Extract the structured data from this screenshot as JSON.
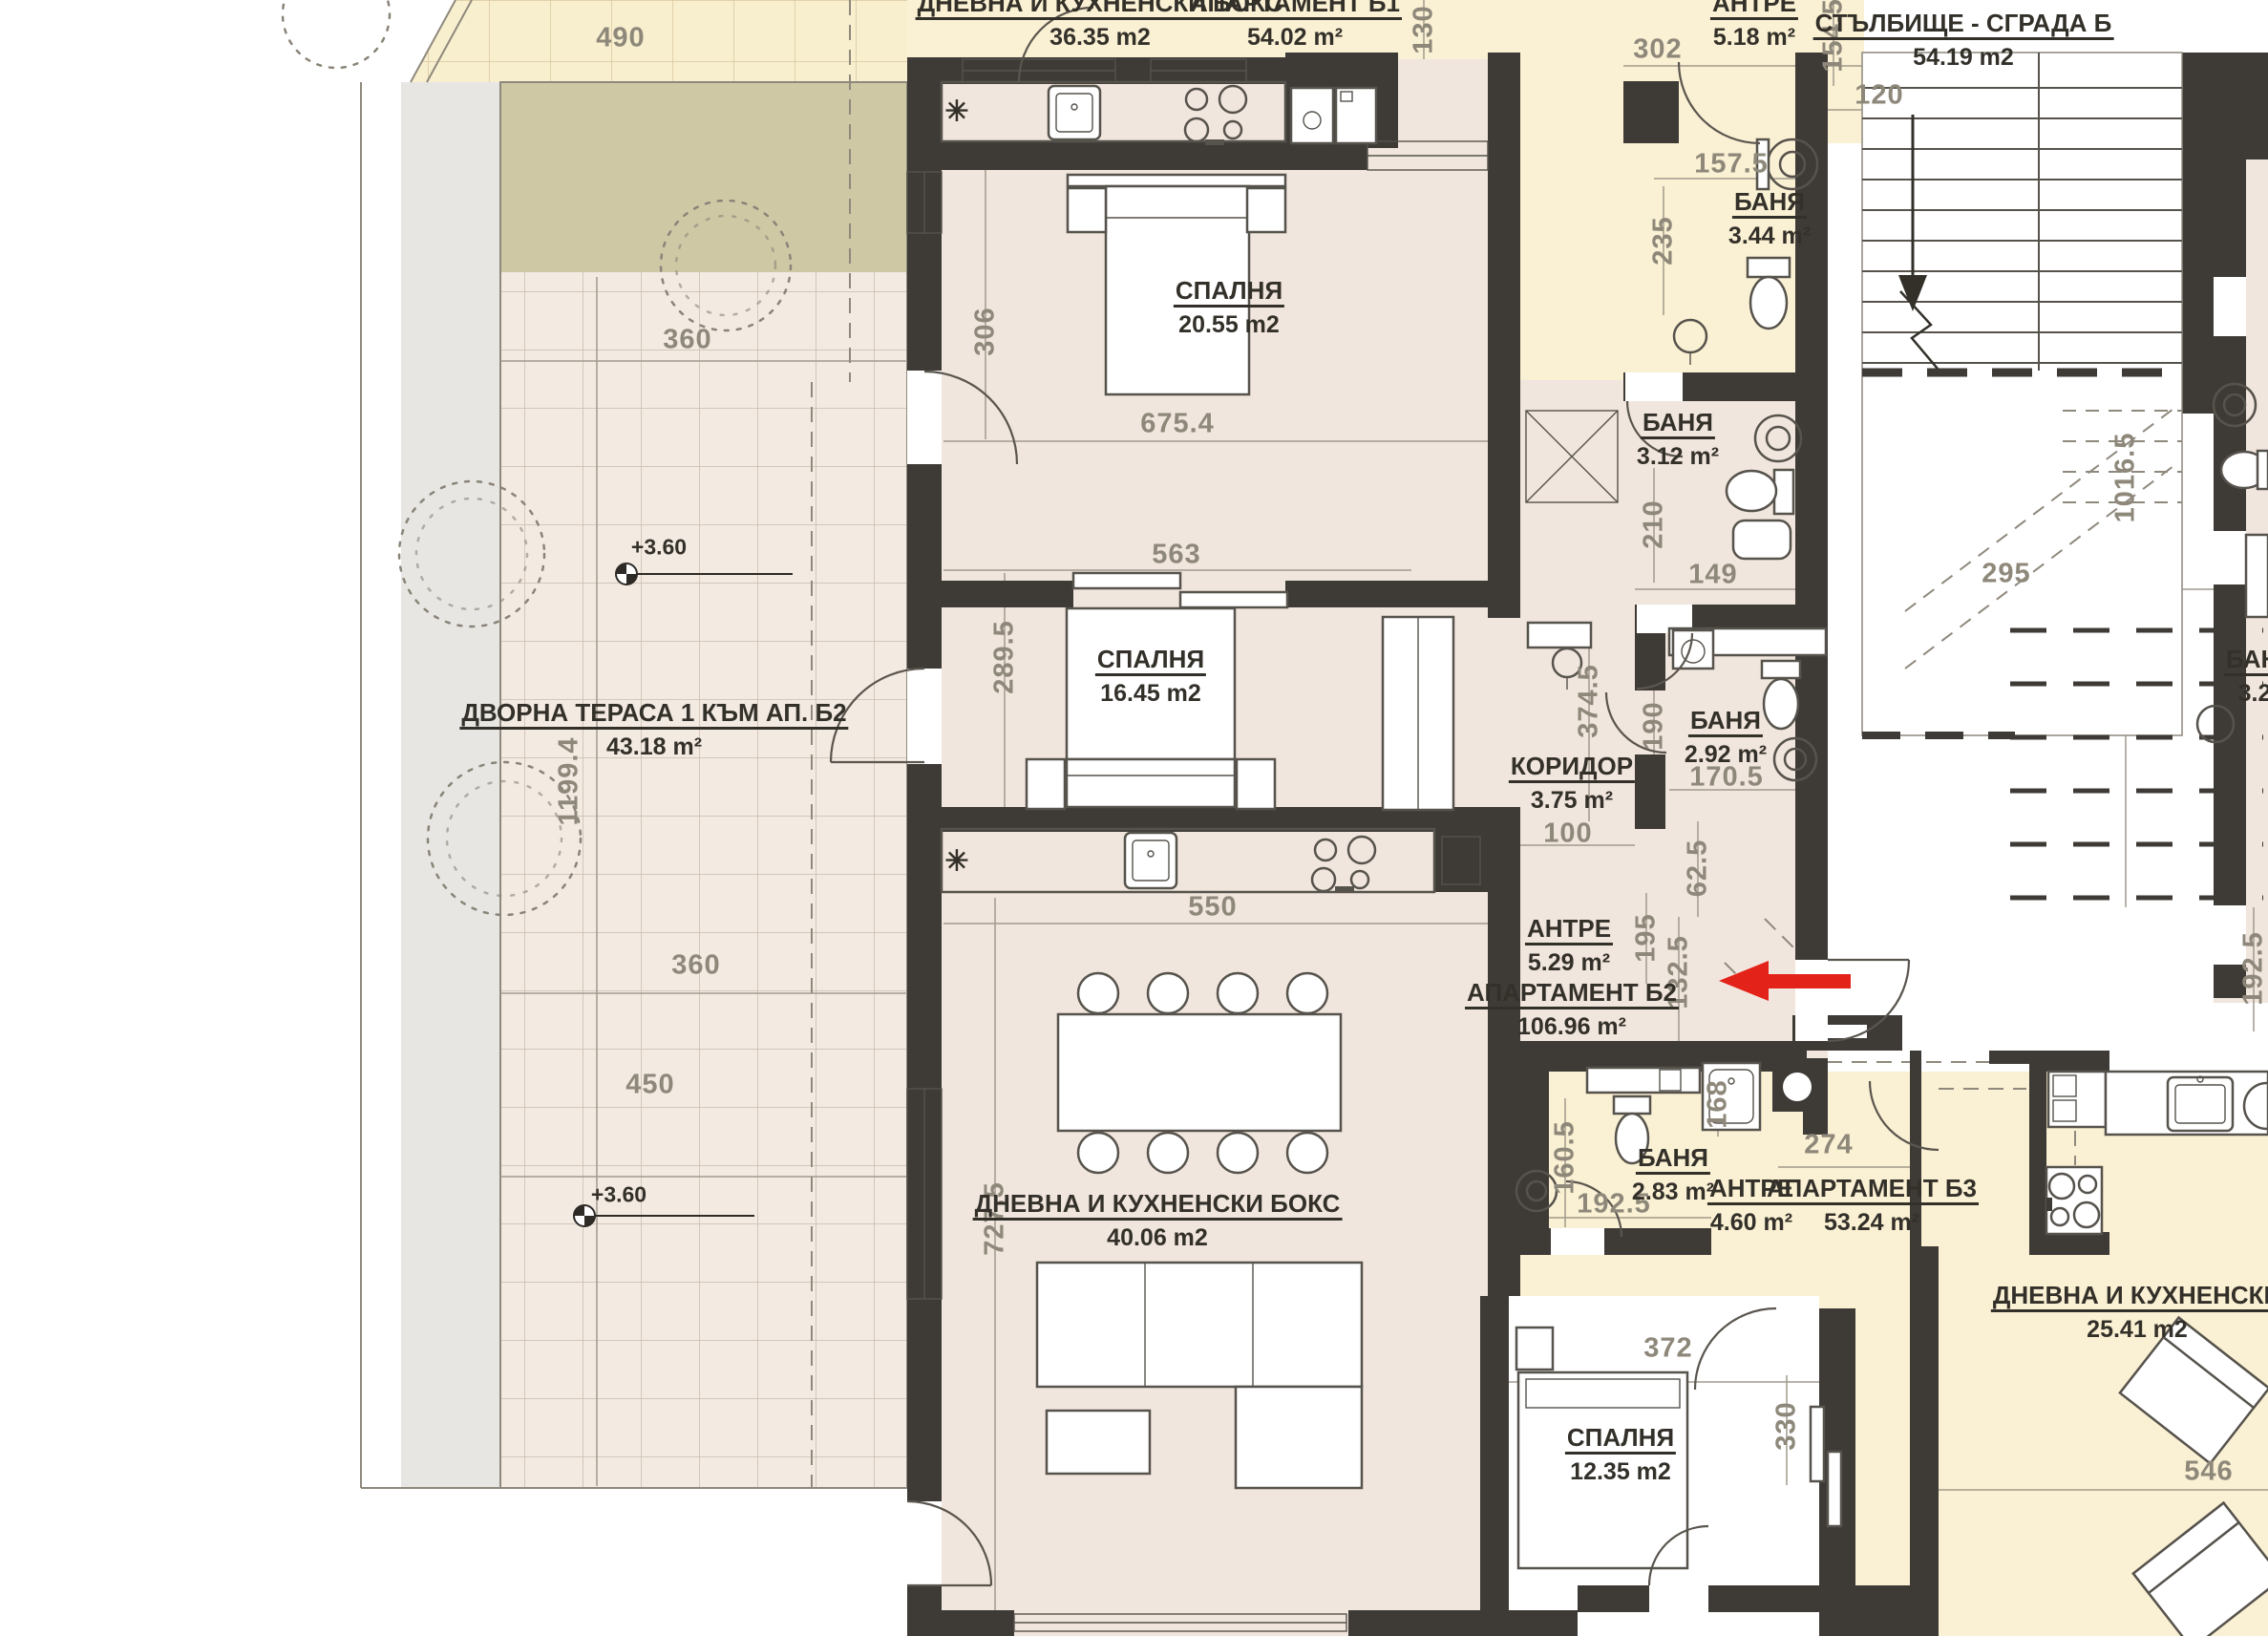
{
  "title": "Floor plan – Building B",
  "colors": {
    "wall": "#3e3a36",
    "room_beige": "#f1e6dd",
    "zone_yellow": "#faf0d3",
    "terrace_tile": "#f3eae2",
    "olive": "#cfc8a5",
    "grey_strip": "#e7e6e3",
    "dim_text": "#8e887a",
    "label_text": "#33302a",
    "arrow_red": "#e32219"
  },
  "labels": {
    "b1_living_name": "ДНЕВНА И КУХНЕНСКИ БОКС",
    "b1_living_area": "36.35 m2",
    "b1_apt_name": "АПАРТАМЕНТ Б1",
    "b1_apt_area": "54.02 m²",
    "b1_antre_name": "АНТРЕ",
    "b1_antre_area": "5.18 m²",
    "b1_bath_name": "БАНЯ",
    "b1_bath_area": "3.44 m²",
    "stairs_name": "СТЪЛБИЩЕ - СГРАДА Б",
    "stairs_area": "54.19 m2",
    "b2_bed1_name": "СПАЛНЯ",
    "b2_bed1_area": "20.55 m2",
    "b2_bath1_name": "БАНЯ",
    "b2_bath1_area": "3.12 m²",
    "b2_bed2_name": "СПАЛНЯ",
    "b2_bed2_area": "16.45 m2",
    "terrace_name": "ДВОРНА ТЕРАСА 1 КЪМ АП. Б2",
    "terrace_area": "43.18 m²",
    "b2_corridor_name": "КОРИДОР",
    "b2_corridor_area": "3.75 m²",
    "b2_bath2_name": "БАНЯ",
    "b2_bath2_area": "2.92 m²",
    "b2_antre_name": "АНТРЕ",
    "b2_antre_area": "5.29 m²",
    "b2_apt_name": "АПАРТАМЕНТ Б2",
    "b2_apt_area": "106.96 m²",
    "b2_living_name": "ДНЕВНА И КУХНЕНСКИ БОКС",
    "b2_living_area": "40.06 m2",
    "b3_bath_name": "БАНЯ",
    "b3_bath_area": "2.83 m²",
    "b3_antre_name": "АНТРЕ",
    "b3_antre_area": "4.60 m²",
    "b3_apt_name": "АПАРТАМЕНТ Б3",
    "b3_apt_area": "53.24 m²",
    "b3_bed_name": "СПАЛНЯ",
    "b3_bed_area": "12.35 m2",
    "b3_living_name": "ДНЕВНА И КУХНЕНСКИ",
    "b3_living_area": "25.41 m2",
    "right_bath_name": "БАНЯ",
    "right_bath_area": "3.28"
  },
  "levels": {
    "l1": "+3.60",
    "l2": "+3.60"
  },
  "symbols": {
    "radiator": "✳"
  },
  "dims": {
    "d490": "490",
    "d360a": "360",
    "d1199": "1199.4",
    "d360b": "360",
    "d450": "450",
    "d130": "130",
    "d302": "302",
    "d1545": "154.5",
    "d120": "120",
    "d1575": "157.5",
    "d235": "235",
    "d306": "306",
    "d6754": "675.4",
    "d563": "563",
    "d2895": "289.5",
    "d210": "210",
    "d149": "149",
    "d295": "295",
    "d10165": "1016.5",
    "d3745": "374.5",
    "d190": "190",
    "d1705": "170.5",
    "d100": "100",
    "d625": "62.5",
    "d195": "195",
    "d1325": "132.5",
    "d550": "550",
    "d7275": "727.5",
    "d1605": "160.5",
    "d1925": "192.5",
    "d168": "168",
    "d274": "274",
    "d372": "372",
    "d330": "330",
    "d546": "546",
    "d1925r": "192.5"
  }
}
